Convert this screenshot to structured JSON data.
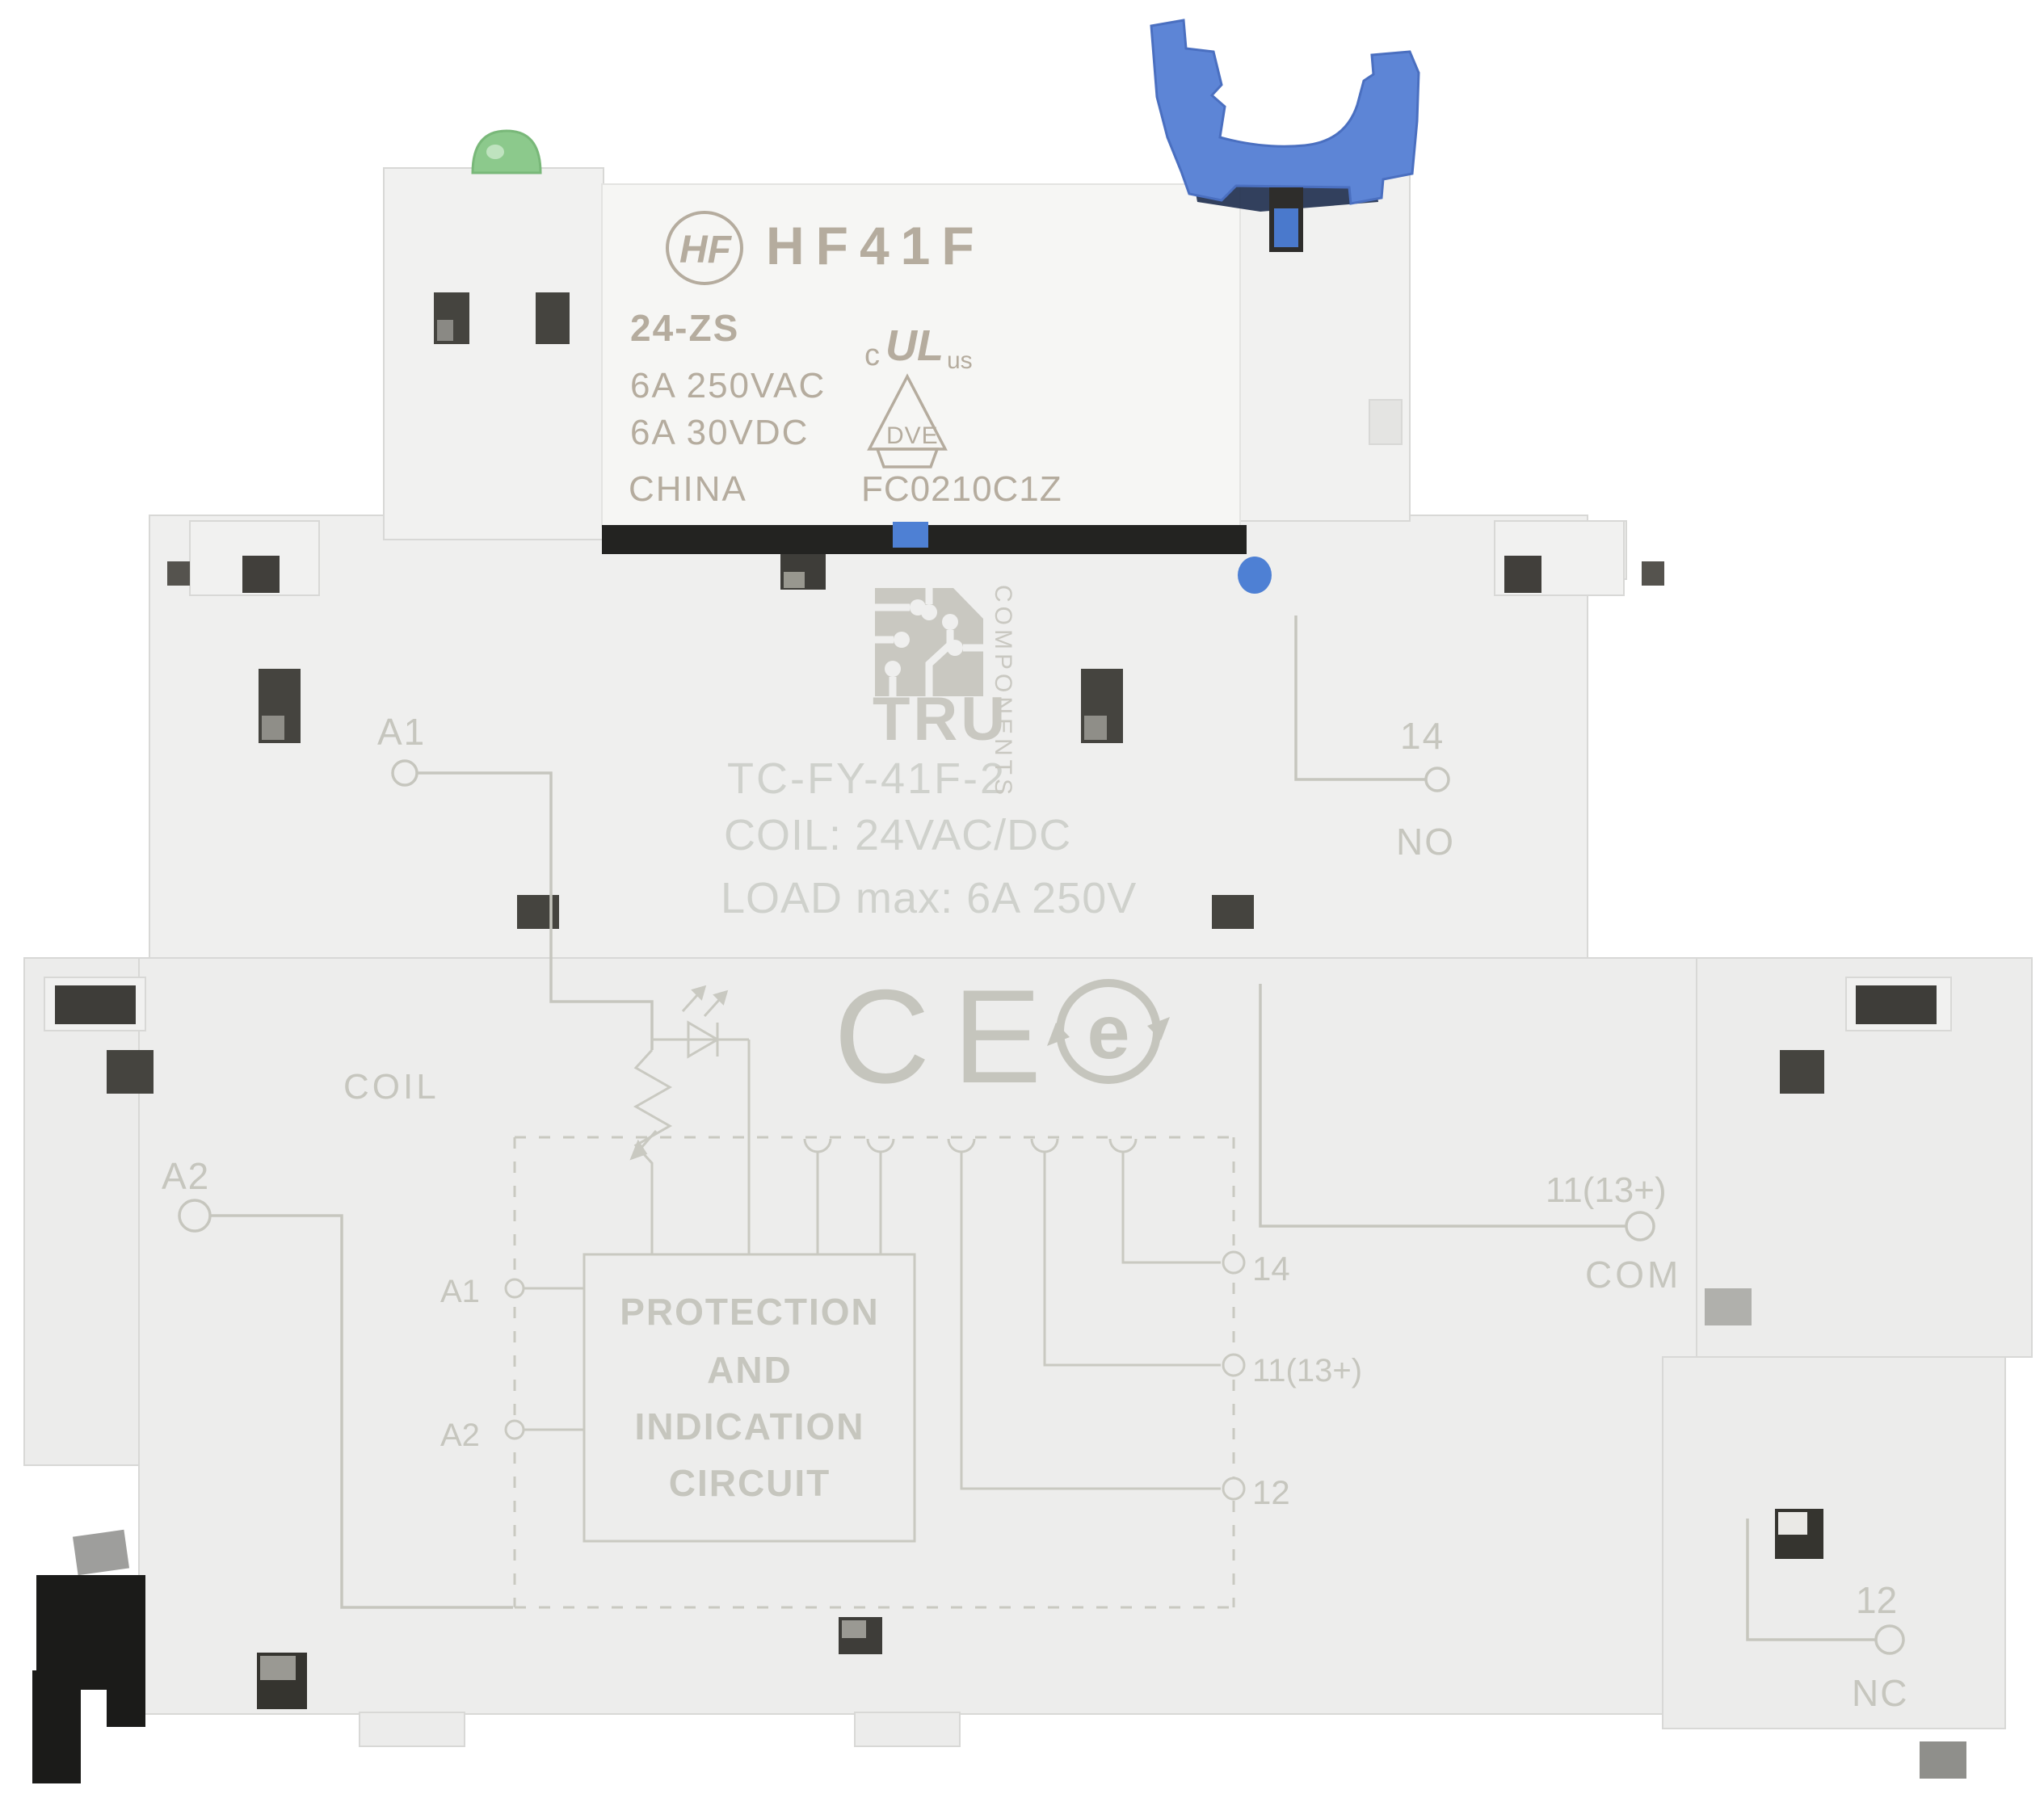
{
  "relay": {
    "logo": "HF",
    "model": "HF41F",
    "type_code": "24-ZS",
    "rating_ac": "6A 250VAC",
    "rating_dc": "6A 30VDC",
    "origin": "CHINA",
    "code": "FC0210C1Z",
    "ul_mark": {
      "c": "c",
      "ul": "UL",
      "us": "us"
    },
    "vde_mark": "DVE"
  },
  "socket": {
    "brand": {
      "name": "TRU",
      "subtitle": "COMPONENTS"
    },
    "model": "TC-FY-41F-2",
    "coil_spec": "COIL:  24VAC/DC",
    "load_spec": "LOAD max: 6A  250V",
    "section_label": "COIL",
    "ce_mark": "CE",
    "rohs_mark": "e",
    "terminals": {
      "a1": "A1",
      "a2": "A2",
      "no_num": "14",
      "no_label": "NO",
      "com_num": "11(13+)",
      "com_label": "COM",
      "nc_num": "12",
      "nc_label": "NC"
    },
    "diagram": {
      "box_line1": "PROTECTION",
      "box_line2": "AND",
      "box_line3": "INDICATION",
      "box_line4": "CIRCUIT",
      "pin_a1": "A1",
      "pin_a2": "A2",
      "pin_14": "14",
      "pin_11": "11(13+)",
      "pin_12": "12"
    }
  },
  "colors": {
    "background": "#ffffff",
    "housing": "#ededec",
    "relay_body": "#f6f6f4",
    "clip_blue": "#5d85d6",
    "led_green": "#8cc98c",
    "engraving": "#c6c6be",
    "socket_print": "#cfd1cc",
    "relay_print": "#b5ac9e",
    "din_clip_black": "#1b1b19"
  }
}
